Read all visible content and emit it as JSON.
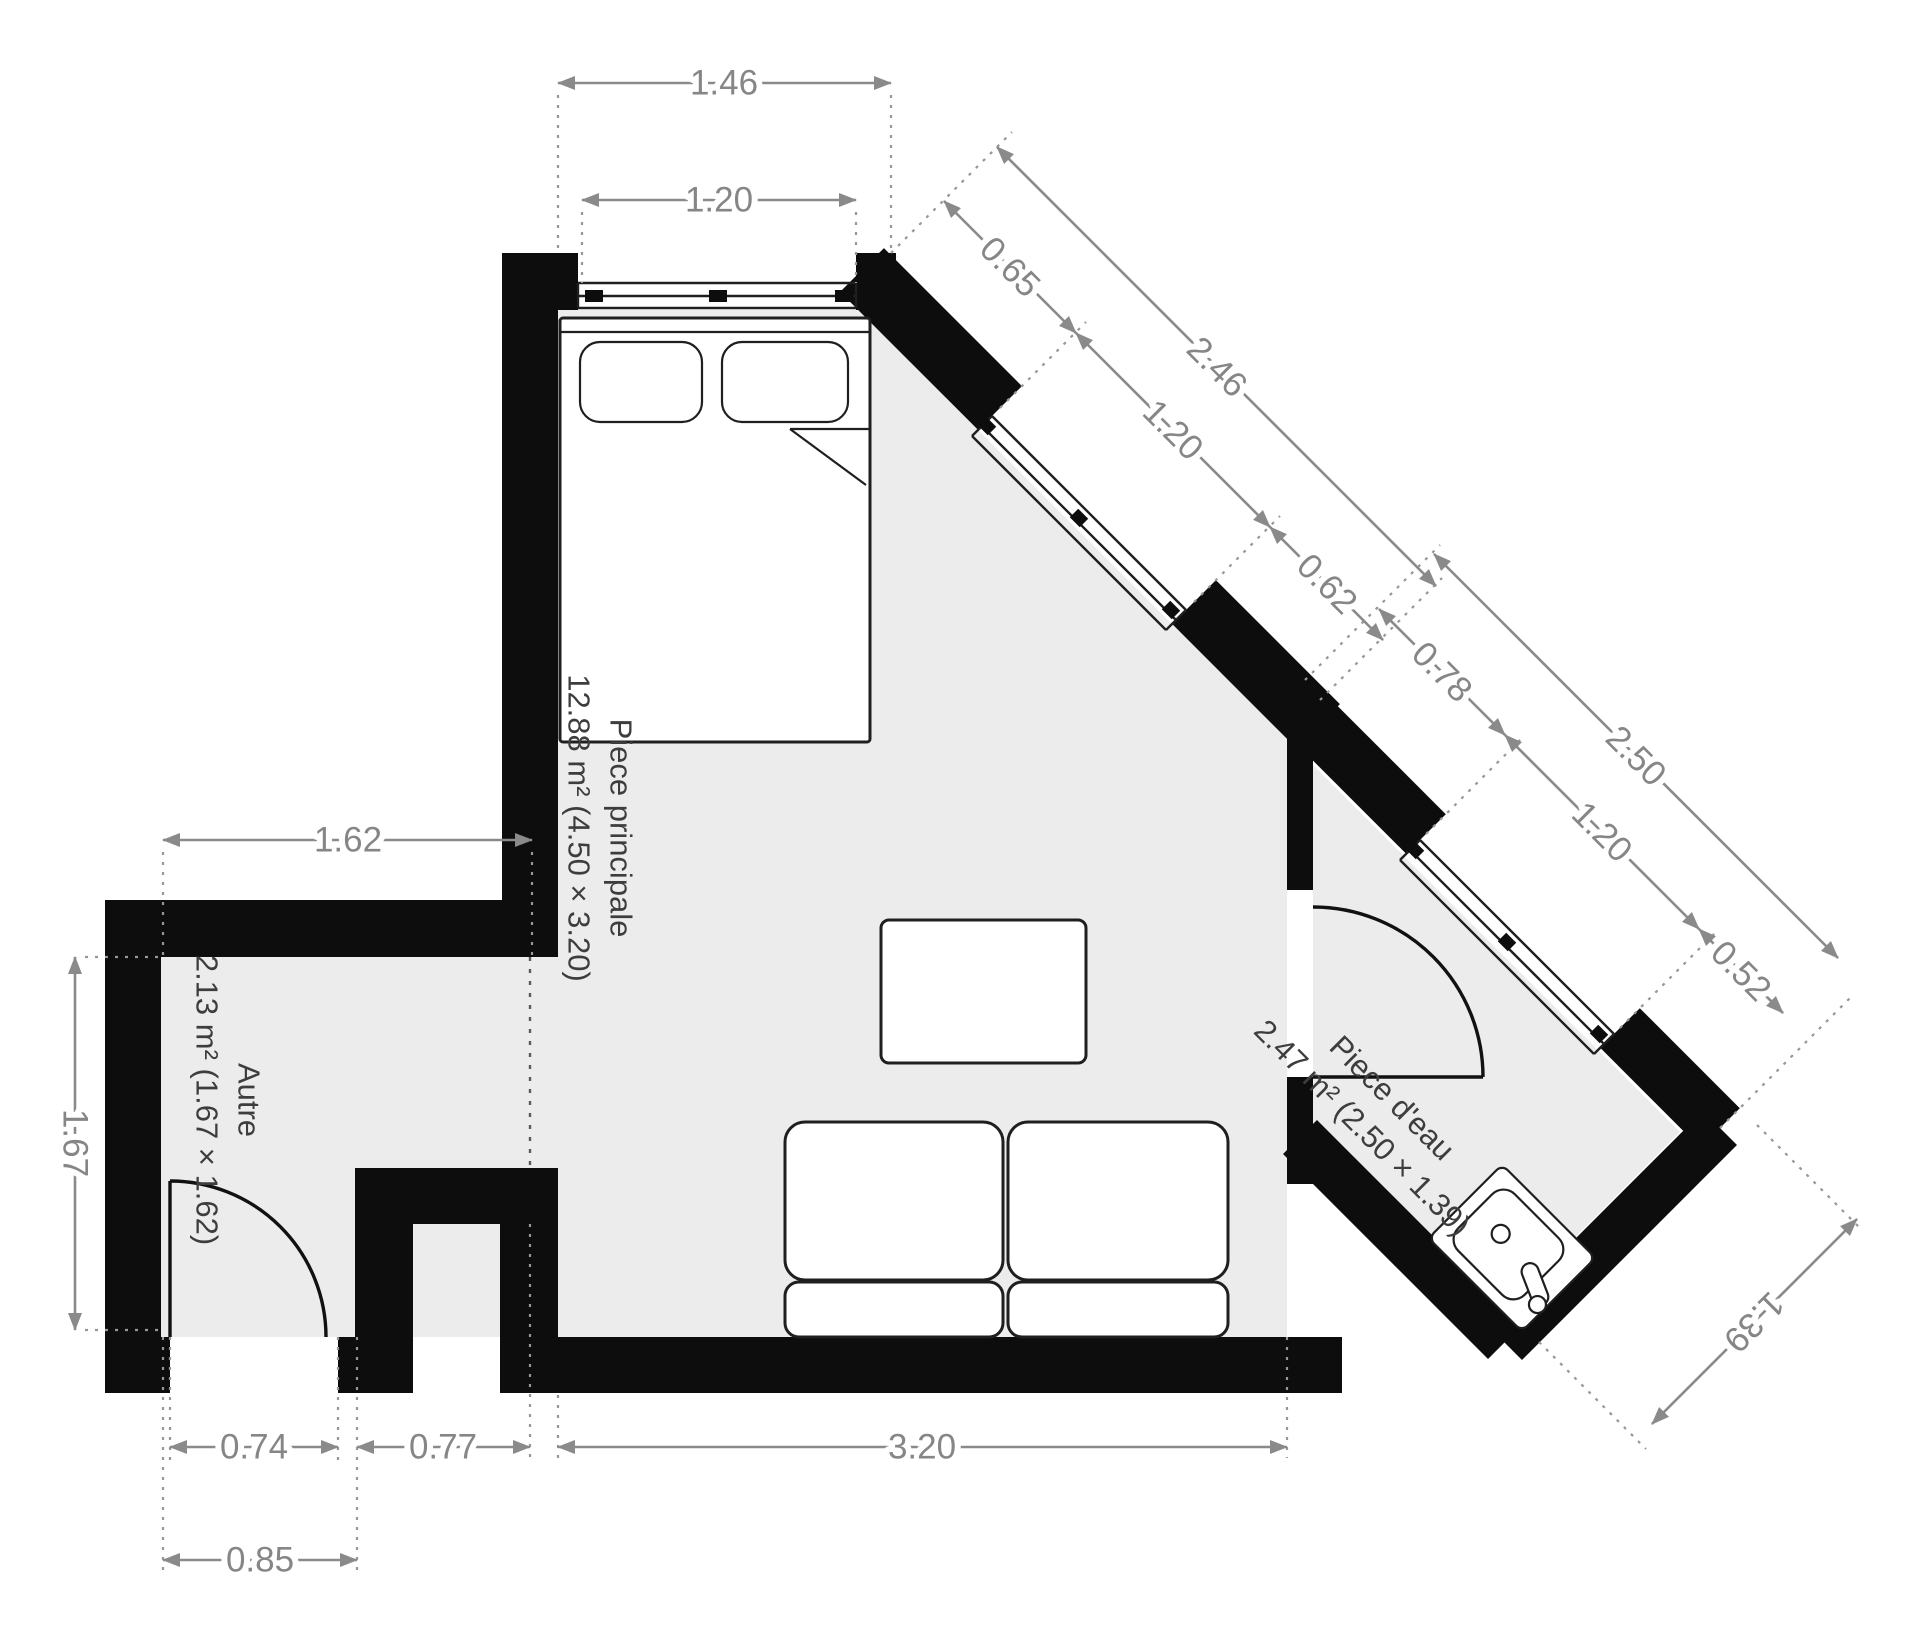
{
  "plan": {
    "type": "floorplan",
    "rooms": [
      {
        "id": "piece_principale",
        "name": "Piece principale",
        "details": "12.88 m² (4.50 × 3.20)"
      },
      {
        "id": "autre",
        "name": "Autre",
        "details": "2.13 m² (1.67 × 1.62)"
      },
      {
        "id": "piece_eau",
        "name": "Piece d'eau",
        "details": "2.47 m² (2.50 × 1.39)"
      }
    ],
    "dimensions": {
      "top_wall": "1.46",
      "top_window": "1.20",
      "diag1_seg_a": "0.65",
      "diag1_total": "2.46",
      "diag1_window": "1.20",
      "diag1_seg_b": "0.62",
      "diag2_seg_a": "0.78",
      "diag2_total": "2.50",
      "diag2_window": "1.20",
      "diag2_seg_b": "0.52",
      "autre_width": "1.62",
      "autre_height": "1.67",
      "autre_door": "0.74",
      "autre_door_frame": "0.85",
      "niche_width": "0.77",
      "main_width": "3.20",
      "bath_side": "1.39"
    },
    "furniture": [
      "double-bed",
      "coffee-table",
      "sofa",
      "bathroom-sink"
    ],
    "colors": {
      "wall": "#0d0d0d",
      "floor": "#ececec",
      "dimension": "#8a8a8a",
      "room_text": "#3d3d3d"
    }
  }
}
